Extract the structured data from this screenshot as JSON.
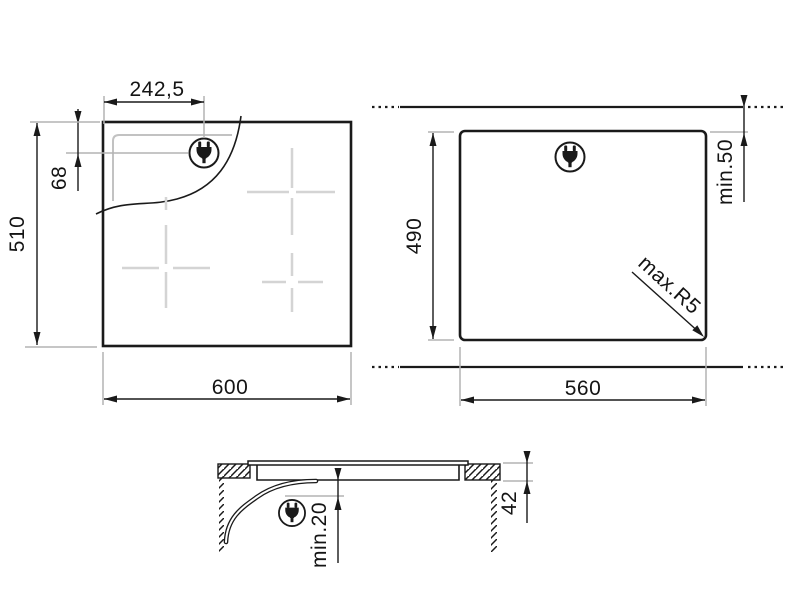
{
  "colors": {
    "line": "#1a1a1a",
    "extension": "#b3b3b3",
    "zone": "#d4d4d4",
    "background": "#ffffff"
  },
  "icons": {
    "plug": "power-plug-icon"
  },
  "top_view": {
    "width": "600",
    "height": "510",
    "plug_offset_x": "242,5",
    "plug_offset_y": "68"
  },
  "cutout_view": {
    "width": "560",
    "height": "490",
    "rear_clearance": "min.50",
    "corner_radius": "max.R5"
  },
  "side_view": {
    "clearance_below": "min.20",
    "hob_height": "42"
  }
}
